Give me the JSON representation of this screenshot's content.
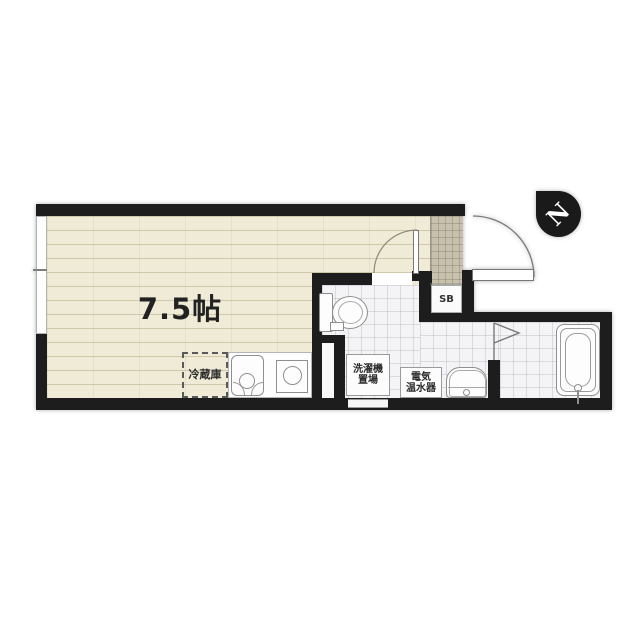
{
  "floorplan": {
    "room": {
      "size_label": "7.5帖"
    },
    "kitchen": {
      "refrigerator_label": "冷蔵庫"
    },
    "washroom": {
      "washer_label_line1": "洗濯機",
      "washer_label_line2": "置場",
      "heater_label_line1": "電気",
      "heater_label_line2": "温水器"
    },
    "entrance": {
      "shoebox_label": "SB"
    },
    "compass": {
      "north_label": "N"
    },
    "colors": {
      "wall": "#1d1d1d",
      "wood_floor": "#f0ebd7",
      "tile_floor": "#f4f4f6",
      "genkan_tile": "#c7c1ae",
      "compass_bg": "#1a1a1a",
      "text": "#222222"
    }
  }
}
